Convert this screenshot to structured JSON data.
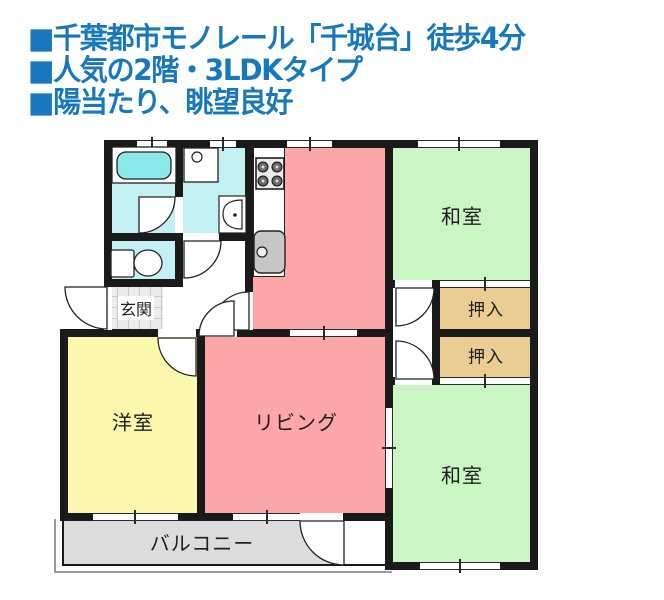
{
  "header": {
    "accent_color": "#1878BC",
    "lines": [
      "■千葉都市モノレール「千城台」徒歩4分",
      "■人気の2階・3LDKタイプ",
      "■陽当たり、眺望良好"
    ]
  },
  "floorplan": {
    "wall_color": "#1a1a1a",
    "rooms": {
      "washitsu_top": {
        "label": "和室",
        "color": "#C9F6C3"
      },
      "washitsu_bottom": {
        "label": "和室",
        "color": "#C9F6C3"
      },
      "oshiire_top": {
        "label": "押入",
        "color": "#EACD92"
      },
      "oshiire_bottom": {
        "label": "押入",
        "color": "#EACD92"
      },
      "living": {
        "label": "リビング",
        "color": "#FBA6A8"
      },
      "kitchen": {
        "label": "",
        "color": "#FBA6A8"
      },
      "youshitsu": {
        "label": "洋室",
        "color": "#FBF7AD"
      },
      "genkan": {
        "label": "玄関",
        "color": "#ECECEC"
      },
      "balcony": {
        "label": "バルコニー",
        "color": "#DCDCDC"
      },
      "bathroom": {
        "color": "#C3F1F3"
      },
      "washroom": {
        "color": "#C3F1F3"
      },
      "toilet": {
        "color": "#C3F1F3"
      }
    },
    "fixtures": [
      "bathtub",
      "washing-machine",
      "vanity-sink",
      "toilet",
      "gas-stove",
      "kitchen-sink"
    ]
  }
}
